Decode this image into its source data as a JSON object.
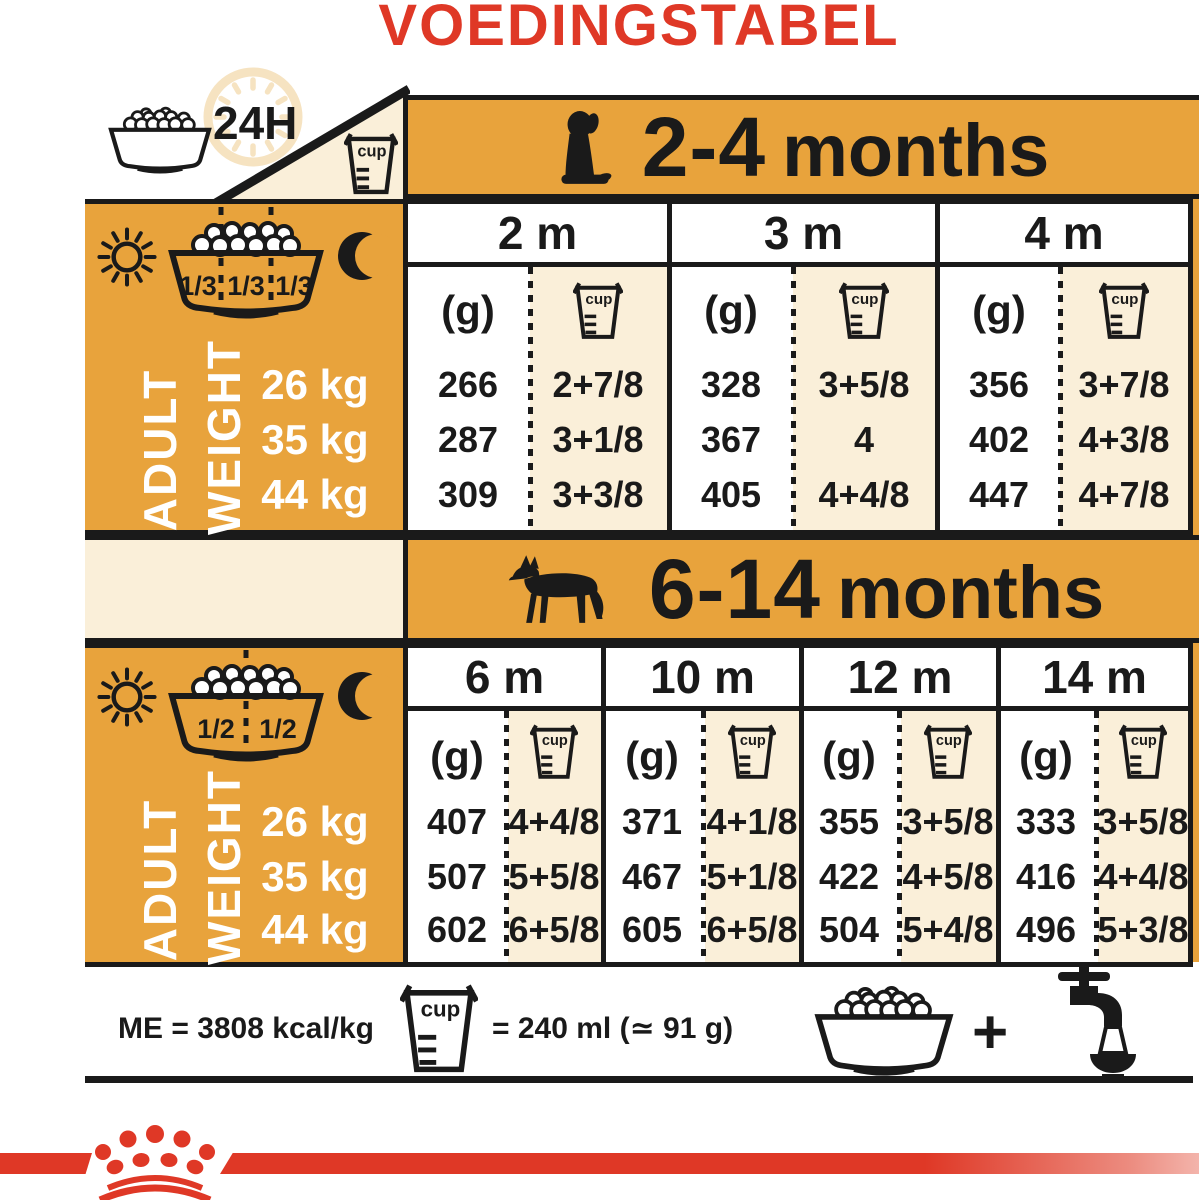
{
  "title": "VOEDINGSTABEL",
  "colors": {
    "orange": "#E8A33C",
    "cream": "#FAEFD9",
    "red": "#DF3826",
    "black": "#1A1A1A"
  },
  "intro": {
    "duration_label": "24H",
    "cup_label": "cup"
  },
  "sections": [
    {
      "range": "2-4",
      "range_unit": "months",
      "bowl_fractions": [
        "1/3",
        "1/3",
        "1/3"
      ],
      "adult_word": "ADULT",
      "weight_word": "WEIGHT",
      "grams_header": "(g)",
      "cup_label": "cup",
      "weights": [
        "26 kg",
        "35 kg",
        "44 kg"
      ],
      "months": [
        {
          "label": "2 m",
          "grams": [
            "266",
            "287",
            "309"
          ],
          "cups": [
            "2+7/8",
            "3+1/8",
            "3+3/8"
          ]
        },
        {
          "label": "3 m",
          "grams": [
            "328",
            "367",
            "405"
          ],
          "cups": [
            "3+5/8",
            "4",
            "4+4/8"
          ]
        },
        {
          "label": "4 m",
          "grams": [
            "356",
            "402",
            "447"
          ],
          "cups": [
            "3+7/8",
            "4+3/8",
            "4+7/8"
          ]
        }
      ]
    },
    {
      "range": "6-14",
      "range_unit": "months",
      "bowl_fractions": [
        "1/2",
        "1/2"
      ],
      "adult_word": "ADULT",
      "weight_word": "WEIGHT",
      "grams_header": "(g)",
      "cup_label": "cup",
      "weights": [
        "26 kg",
        "35 kg",
        "44 kg"
      ],
      "months": [
        {
          "label": "6 m",
          "grams": [
            "407",
            "507",
            "602"
          ],
          "cups": [
            "4+4/8",
            "5+5/8",
            "6+5/8"
          ]
        },
        {
          "label": "10 m",
          "grams": [
            "371",
            "467",
            "605"
          ],
          "cups": [
            "4+1/8",
            "5+1/8",
            "6+5/8"
          ]
        },
        {
          "label": "12 m",
          "grams": [
            "355",
            "422",
            "504"
          ],
          "cups": [
            "3+5/8",
            "4+5/8",
            "5+4/8"
          ]
        },
        {
          "label": "14 m",
          "grams": [
            "333",
            "416",
            "496"
          ],
          "cups": [
            "3+5/8",
            "4+4/8",
            "5+3/8"
          ]
        }
      ]
    }
  ],
  "footer": {
    "me_text": "ME = 3808 kcal/kg",
    "cup_label": "cup",
    "cup_equivalence": "= 240 ml (≃ 91 g)",
    "plus": "+"
  }
}
